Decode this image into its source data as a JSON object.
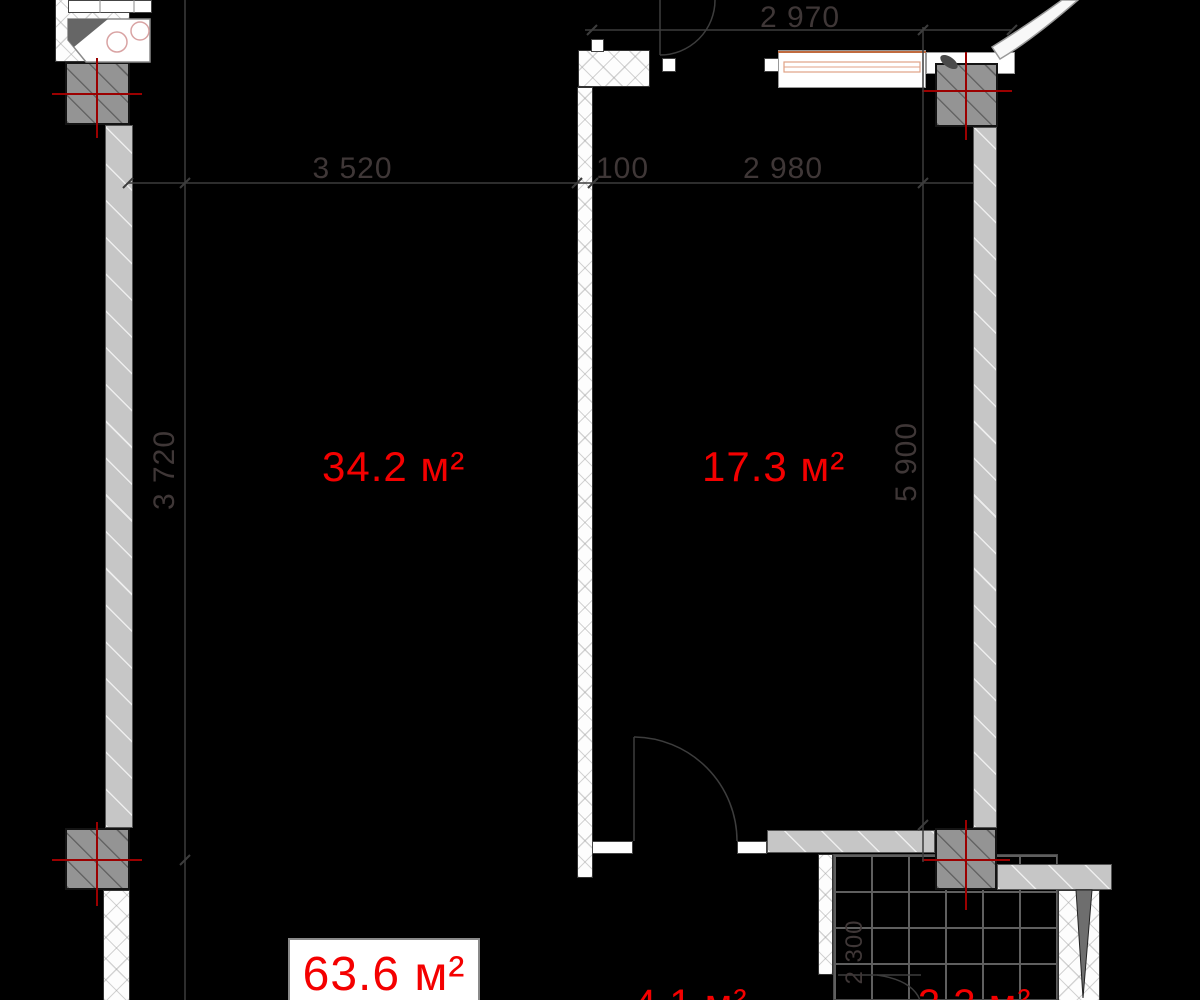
{
  "drawing_title": "apartment-floor-plan",
  "colors": {
    "background": "#000000",
    "room_label_red": "#f40000",
    "centerline_red": "#9b0000",
    "dimension_text": "#3f3737",
    "wall_light_gray": "#c6c6c6",
    "column_gray": "#949494",
    "tile_line_gray": "#5f5f5f",
    "window_accent_orange": "#c06a3e"
  },
  "rooms": [
    {
      "name": "living-room",
      "area_label": "34.2 м²"
    },
    {
      "name": "bedroom",
      "area_label": "17.3 м²"
    },
    {
      "name": "hallway",
      "area_label": "4.1 м²"
    },
    {
      "name": "bathroom",
      "area_label": "3.3 м²"
    }
  ],
  "total_area": {
    "label": "63.6 м²"
  },
  "dimensions": {
    "top_width": "2 970",
    "width_left": "3 520",
    "wall_thickness": "100",
    "width_right": "2 980",
    "height_left": "3 720",
    "height_right": "5 900",
    "bathroom_width": "2 300"
  }
}
